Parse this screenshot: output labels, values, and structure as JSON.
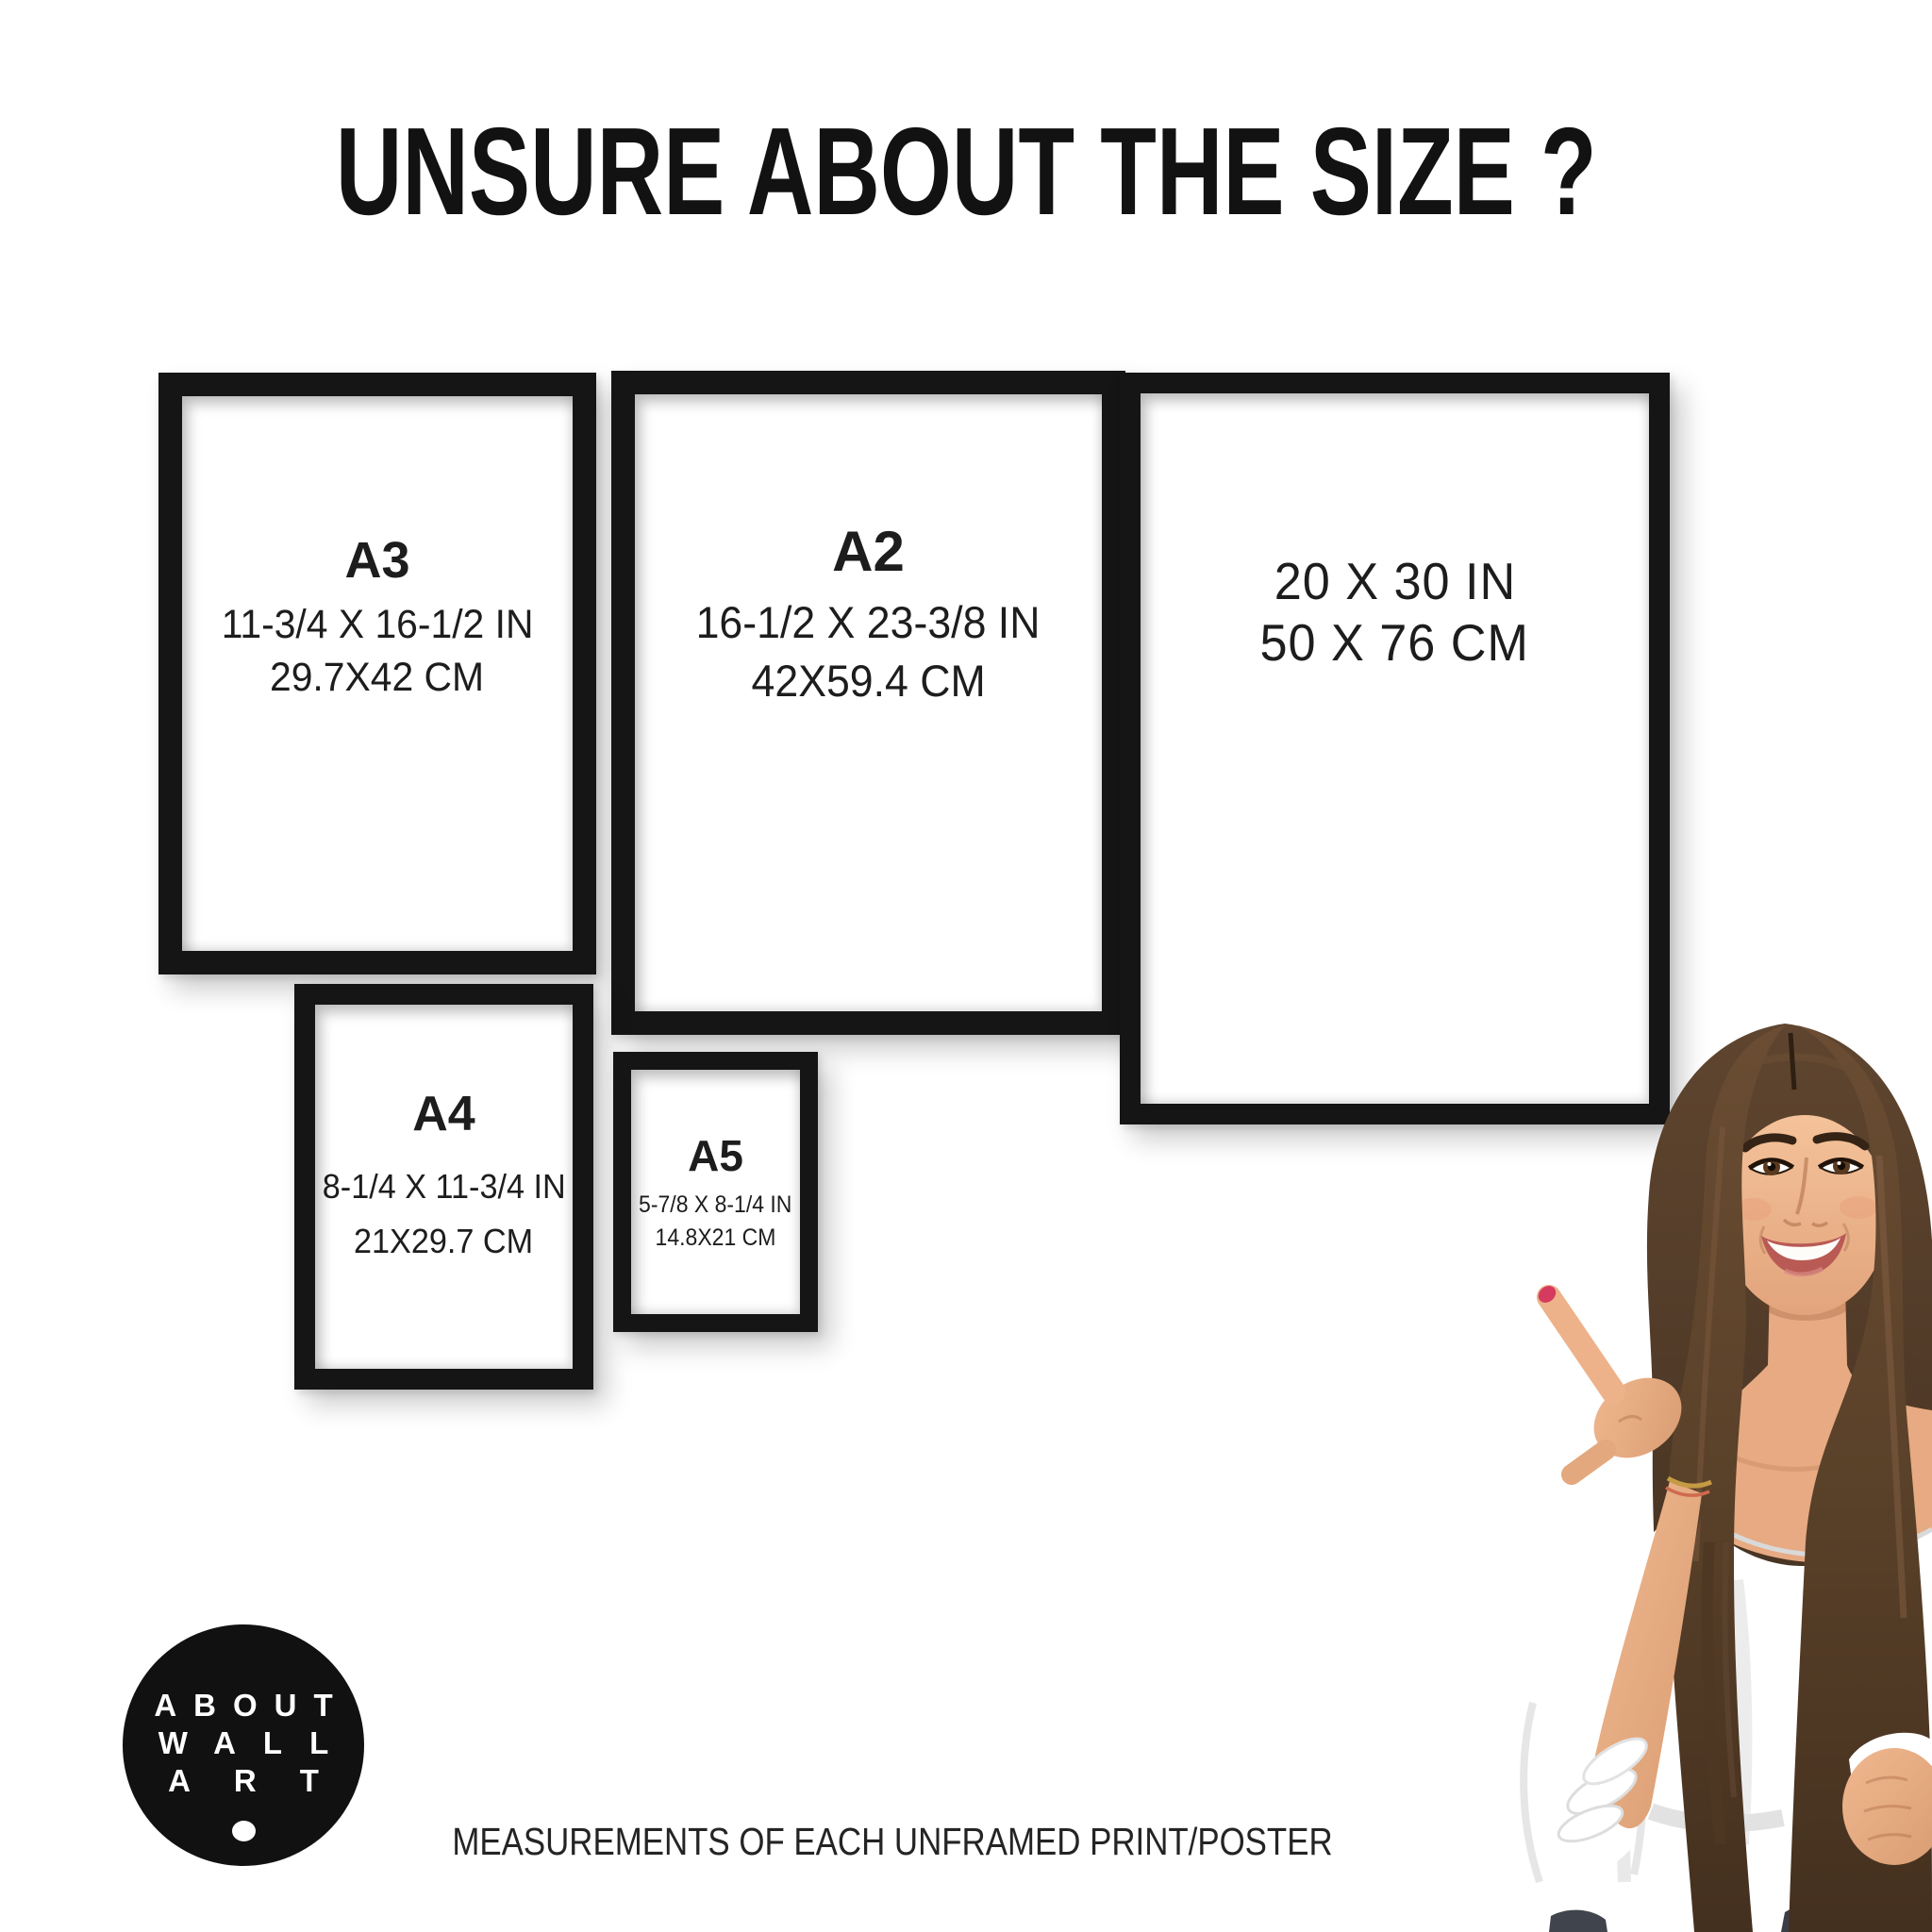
{
  "header": {
    "title": "UNSURE ABOUT THE SIZE ?"
  },
  "frames": {
    "a3": {
      "label": "A3",
      "inches": "11-3/4 X 16-1/2 IN",
      "cm": "29.7X42 CM"
    },
    "a2": {
      "label": "A2",
      "inches": "16-1/2 X 23-3/8 IN",
      "cm": "42X59.4 CM"
    },
    "poster_20x30": {
      "inches": "20 X 30 IN",
      "cm": "50 X 76 CM"
    },
    "a4": {
      "label": "A4",
      "inches": "8-1/4 X 11-3/4 IN",
      "cm": "21X29.7 CM"
    },
    "a5": {
      "label": "A5",
      "inches": "5-7/8 X 8-1/4 IN",
      "cm": "14.8X21 CM"
    }
  },
  "logo": {
    "line1": "ABOUT",
    "line2": "WALL",
    "line3": "ART"
  },
  "footer": {
    "text": "MEASUREMENTS OF EACH UNFRAMED PRINT/POSTER"
  },
  "colors": {
    "background": "#ffffff",
    "frame": "#151515",
    "text": "#1d1d1d",
    "logo_background": "#111111",
    "logo_text": "#ffffff",
    "nail_polish": "#d63a5e",
    "hair": "#4e3826",
    "skin": "#eab28b",
    "blouse": "#ffffff"
  }
}
